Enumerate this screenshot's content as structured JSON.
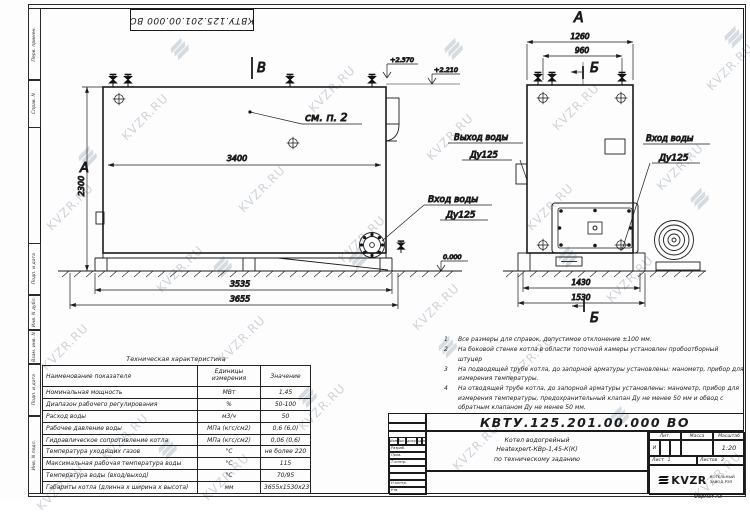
{
  "sheet": {
    "watermark_text": "KVZR.RU",
    "top_stamp": "КВТУ.125.201.00.000  ВО",
    "format_label": "Формат  А3"
  },
  "frame_left": {
    "labels": [
      "Перв. примен.",
      "Справ. N",
      "Подп. и дата",
      "Инв. N дубл.",
      "Взам. инв. N",
      "Подп. и дата",
      "Инв. N подл."
    ]
  },
  "left_view": {
    "marker_top": "В",
    "marker_left": "А",
    "note_ref": "см. п. 2",
    "dim_inner_width": "3400",
    "dim_height": "2300",
    "elev_top": "+2.370",
    "elev_mid": "+2.210",
    "elev_zero": "0.000",
    "inlet_line1": "Вход воды",
    "inlet_line2": "Ду125",
    "dim_base": "3535",
    "dim_overall": "3655"
  },
  "right_view": {
    "view_label": "А",
    "section_marker": "Б",
    "dim_top_outer": "1260",
    "dim_top_inner": "960",
    "outlet_line1": "Выход воды",
    "outlet_line2": "Ду125",
    "inlet_line1": "Вход воды",
    "inlet_line2": "Ду125",
    "dim_base": "1430",
    "dim_overall": "1530"
  },
  "notes": [
    {
      "num": "1",
      "text": "Все размеры для справок, допустимое отклонение  ±100 мм."
    },
    {
      "num": "2",
      "text": "На боковой стенке котла в области топочной камеры установлен пробоотборный штуцер"
    },
    {
      "num": "3",
      "text": "На  подводящей трубе котла, до запорной арматуры установлены: манометр, прибор для измерения температуры."
    },
    {
      "num": "4",
      "text": "На отводящей трубе котла, до запорной арматуры установлены: манометр, прибор для измерения температуры, предохранительный клапан  Ду не менее  50 мм и обвод с обратным клапаном  Ду не менее  50 мм."
    }
  ],
  "spec_table": {
    "title": "Техническая характеристика",
    "headers": [
      "Наименование показателя",
      "Единицы измерения",
      "Значение"
    ],
    "rows": [
      [
        "Номинальная мощность",
        "МВт",
        "1,45"
      ],
      [
        "Диапазон рабочего регулирования",
        "%",
        "50-100"
      ],
      [
        "Расход воды",
        "м3/ч",
        "50"
      ],
      [
        "Рабочее давление воды",
        "МПа (кгс/см2)",
        "0,6 (6,0)"
      ],
      [
        "Гидравлическое сопротивление котла",
        "МПа (кгс/см2)",
        "0,06 (0,6)"
      ],
      [
        "Температура уходящих газов",
        "°С",
        "не более 220"
      ],
      [
        "Максимальная рабочая температура воды",
        "°С",
        "115"
      ],
      [
        "Температура воды (вход/выход)",
        "°С",
        "70/95"
      ],
      [
        "Габариты котла (длинна х ширина х высота)",
        "мм",
        "3655х1530х2370"
      ]
    ]
  },
  "title_block": {
    "doc_number": "КВТУ.125.201.00.000  ВО",
    "product_line1": "Котел водогрейный",
    "product_line2": "Heatexpert-КВр-1,45-К(К)",
    "product_line3": "по техническому заданию",
    "col_headers": [
      "Изм",
      "Лист",
      "N докум.",
      "Подп.",
      "Дата"
    ],
    "row_labels": [
      "Разраб.",
      "Пров.",
      "Т.контр.",
      "Н.контр.",
      "Утв."
    ],
    "lit_header": "Лит.",
    "lit_value": "И",
    "mass_header": "Масса",
    "scale_header": "Масштаб",
    "scale_value": "1:20",
    "sheet_label": "Лист",
    "sheet_num": "1",
    "sheets_label": "Листов",
    "sheets_num": "2",
    "logo_text": "KVZR",
    "company_line1": "КОТЕЛЬНЫЙ",
    "company_line2": "ЗАВОД РЭП"
  }
}
